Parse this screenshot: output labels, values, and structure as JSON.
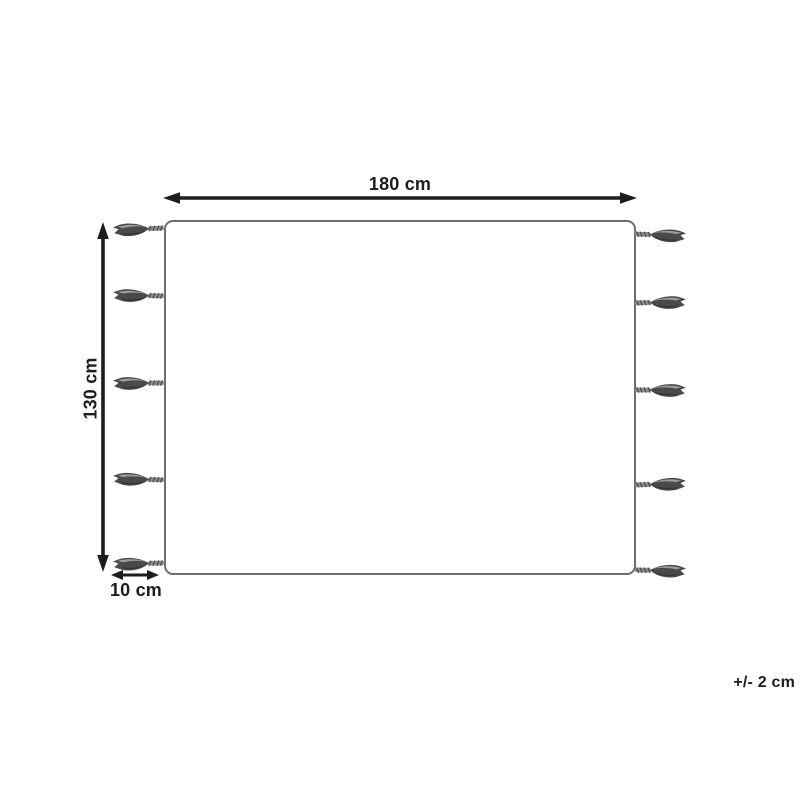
{
  "diagram": {
    "width_label": "180 cm",
    "height_label": "130 cm",
    "tassel_length_label": "10 cm",
    "tolerance_label": "+/- 2 cm",
    "tassels_per_side": 5,
    "colors": {
      "background": "#ffffff",
      "ink": "#1d1d1b",
      "rug_border": "#6e6e6e",
      "tassel_dark": "#4a4a4a",
      "tassel_mid": "#8c8c8c",
      "tassel_light": "#aaaaaa"
    }
  }
}
